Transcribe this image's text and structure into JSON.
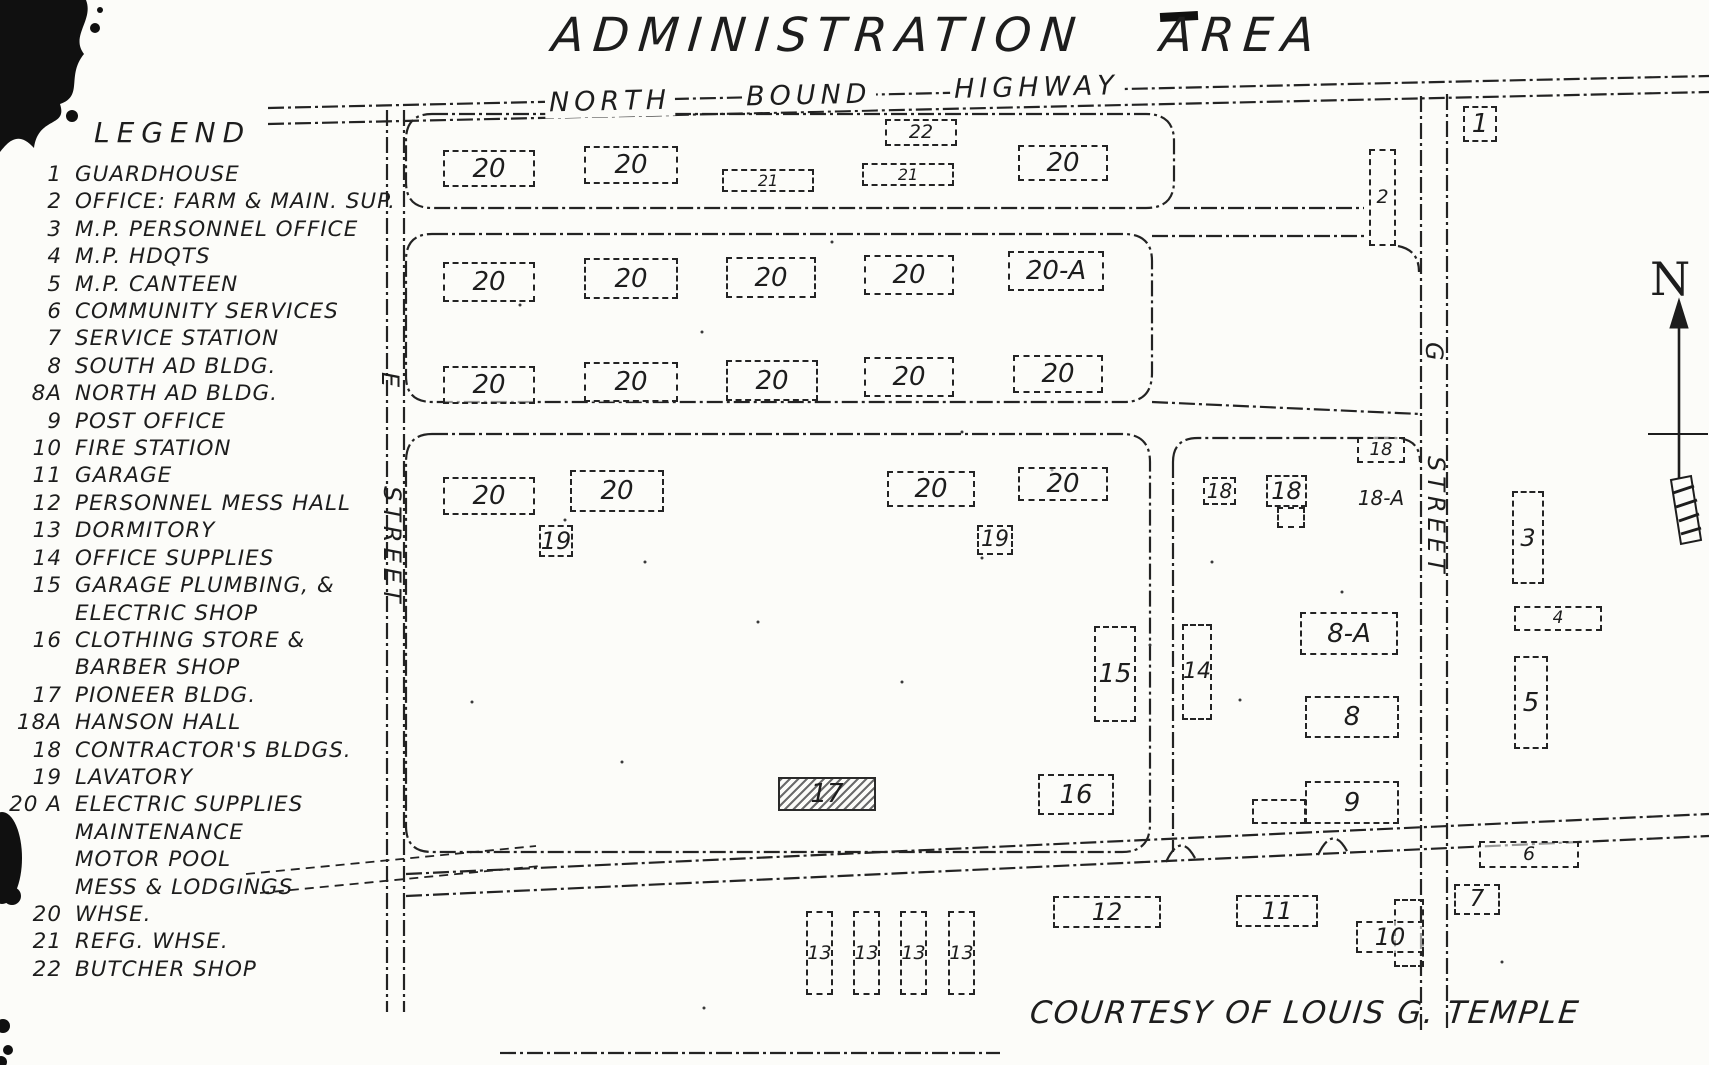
{
  "title": "ADMINISTRATION AREA",
  "credit": "COURTESY OF LOUIS G. TEMPLE",
  "compass": {
    "label": "N"
  },
  "colors": {
    "ink": "#1d1d1d",
    "paper": "#fcfcf9"
  },
  "roads": {
    "highway": {
      "words": [
        "NORTH",
        "BOUND",
        "HIGHWAY"
      ]
    },
    "left_street": {
      "letter": "E",
      "name": "STREET"
    },
    "right_street": {
      "letter": "G",
      "name": "STREET"
    }
  },
  "legend": {
    "heading": "LEGEND",
    "items": [
      {
        "num": "1",
        "lines": [
          "GUARDHOUSE"
        ]
      },
      {
        "num": "2",
        "lines": [
          "OFFICE: FARM & MAIN. SUP."
        ]
      },
      {
        "num": "3",
        "lines": [
          "M.P. PERSONNEL OFFICE"
        ]
      },
      {
        "num": "4",
        "lines": [
          "M.P. HDQTS"
        ]
      },
      {
        "num": "5",
        "lines": [
          "M.P. CANTEEN"
        ]
      },
      {
        "num": "6",
        "lines": [
          "COMMUNITY SERVICES"
        ]
      },
      {
        "num": "7",
        "lines": [
          "SERVICE STATION"
        ]
      },
      {
        "num": "8",
        "lines": [
          "SOUTH AD BLDG."
        ]
      },
      {
        "num": "8A",
        "lines": [
          "NORTH AD BLDG."
        ]
      },
      {
        "num": "9",
        "lines": [
          "POST OFFICE"
        ]
      },
      {
        "num": "10",
        "lines": [
          "FIRE STATION"
        ]
      },
      {
        "num": "11",
        "lines": [
          "GARAGE"
        ]
      },
      {
        "num": "12",
        "lines": [
          "PERSONNEL MESS HALL"
        ]
      },
      {
        "num": "13",
        "lines": [
          "DORMITORY"
        ]
      },
      {
        "num": "14",
        "lines": [
          "OFFICE SUPPLIES"
        ]
      },
      {
        "num": "15",
        "lines": [
          "GARAGE PLUMBING, &",
          "ELECTRIC SHOP"
        ]
      },
      {
        "num": "16",
        "lines": [
          "CLOTHING STORE &",
          "BARBER SHOP"
        ]
      },
      {
        "num": "17",
        "lines": [
          "PIONEER BLDG."
        ]
      },
      {
        "num": "18A",
        "lines": [
          "HANSON HALL"
        ]
      },
      {
        "num": "18",
        "lines": [
          "CONTRACTOR'S BLDGS."
        ]
      },
      {
        "num": "19",
        "lines": [
          "LAVATORY"
        ]
      },
      {
        "num": "20 A",
        "lines": [
          "ELECTRIC SUPPLIES",
          "MAINTENANCE",
          "MOTOR POOL",
          "MESS & LODGINGS"
        ]
      },
      {
        "num": "20",
        "lines": [
          "WHSE."
        ]
      },
      {
        "num": "21",
        "lines": [
          "REFG. WHSE."
        ]
      },
      {
        "num": "22",
        "lines": [
          "BUTCHER SHOP"
        ]
      }
    ]
  },
  "map": {
    "buildings": [
      {
        "label": "20",
        "x": 443,
        "y": 150,
        "w": 92,
        "h": 37
      },
      {
        "label": "20",
        "x": 584,
        "y": 146,
        "w": 94,
        "h": 38
      },
      {
        "label": "21",
        "x": 722,
        "y": 169,
        "w": 92,
        "h": 23
      },
      {
        "label": "21",
        "x": 862,
        "y": 163,
        "w": 92,
        "h": 23
      },
      {
        "label": "22",
        "x": 885,
        "y": 119,
        "w": 72,
        "h": 27
      },
      {
        "label": "20",
        "x": 1018,
        "y": 145,
        "w": 90,
        "h": 36
      },
      {
        "label": "20",
        "x": 443,
        "y": 262,
        "w": 92,
        "h": 40
      },
      {
        "label": "20",
        "x": 584,
        "y": 258,
        "w": 94,
        "h": 41
      },
      {
        "label": "20",
        "x": 726,
        "y": 257,
        "w": 90,
        "h": 41
      },
      {
        "label": "20",
        "x": 864,
        "y": 255,
        "w": 90,
        "h": 40
      },
      {
        "label": "20-A",
        "x": 1008,
        "y": 251,
        "w": 96,
        "h": 40
      },
      {
        "label": "20",
        "x": 443,
        "y": 366,
        "w": 92,
        "h": 38
      },
      {
        "label": "20",
        "x": 584,
        "y": 362,
        "w": 94,
        "h": 40
      },
      {
        "label": "20",
        "x": 726,
        "y": 360,
        "w": 92,
        "h": 41
      },
      {
        "label": "20",
        "x": 864,
        "y": 357,
        "w": 90,
        "h": 40
      },
      {
        "label": "20",
        "x": 1013,
        "y": 355,
        "w": 90,
        "h": 38
      },
      {
        "label": "2",
        "x": 1369,
        "y": 149,
        "w": 27,
        "h": 97
      },
      {
        "label": "1",
        "x": 1463,
        "y": 106,
        "w": 34,
        "h": 36
      },
      {
        "label": "20",
        "x": 443,
        "y": 477,
        "w": 92,
        "h": 38
      },
      {
        "label": "20",
        "x": 570,
        "y": 470,
        "w": 94,
        "h": 42
      },
      {
        "label": "20",
        "x": 887,
        "y": 471,
        "w": 88,
        "h": 36
      },
      {
        "label": "20",
        "x": 1018,
        "y": 467,
        "w": 90,
        "h": 34
      },
      {
        "label": "19",
        "x": 539,
        "y": 525,
        "w": 34,
        "h": 32
      },
      {
        "label": "19",
        "x": 977,
        "y": 525,
        "w": 36,
        "h": 30
      },
      {
        "label": "15",
        "x": 1094,
        "y": 626,
        "w": 42,
        "h": 96
      },
      {
        "label": "17",
        "x": 778,
        "y": 777,
        "w": 98,
        "h": 34,
        "variant": "hatched"
      },
      {
        "label": "16",
        "x": 1038,
        "y": 774,
        "w": 76,
        "h": 41
      },
      {
        "label": "18",
        "x": 1357,
        "y": 437,
        "w": 48,
        "h": 26
      },
      {
        "label": "18",
        "x": 1203,
        "y": 477,
        "w": 33,
        "h": 28
      },
      {
        "label": "18",
        "x": 1266,
        "y": 475,
        "w": 41,
        "h": 32
      },
      {
        "label": "",
        "x": 1277,
        "y": 507,
        "w": 28,
        "h": 21,
        "variant": "annex"
      },
      {
        "label": "18-A",
        "x": 1350,
        "y": 484,
        "w": 62,
        "h": 28,
        "variant": "text"
      },
      {
        "label": "14",
        "x": 1182,
        "y": 624,
        "w": 30,
        "h": 96
      },
      {
        "label": "8-A",
        "x": 1300,
        "y": 612,
        "w": 98,
        "h": 43
      },
      {
        "label": "8",
        "x": 1305,
        "y": 696,
        "w": 94,
        "h": 42
      },
      {
        "label": "9",
        "x": 1305,
        "y": 781,
        "w": 94,
        "h": 43
      },
      {
        "label": "",
        "x": 1252,
        "y": 799,
        "w": 54,
        "h": 25,
        "variant": "annex"
      },
      {
        "label": "3",
        "x": 1512,
        "y": 491,
        "w": 32,
        "h": 93
      },
      {
        "label": "4",
        "x": 1514,
        "y": 606,
        "w": 88,
        "h": 25
      },
      {
        "label": "5",
        "x": 1514,
        "y": 656,
        "w": 34,
        "h": 93
      },
      {
        "label": "6",
        "x": 1479,
        "y": 841,
        "w": 100,
        "h": 27
      },
      {
        "label": "7",
        "x": 1454,
        "y": 884,
        "w": 46,
        "h": 31
      },
      {
        "label": "13",
        "x": 806,
        "y": 911,
        "w": 27,
        "h": 84
      },
      {
        "label": "13",
        "x": 853,
        "y": 911,
        "w": 27,
        "h": 84
      },
      {
        "label": "13",
        "x": 900,
        "y": 911,
        "w": 27,
        "h": 84
      },
      {
        "label": "13",
        "x": 948,
        "y": 911,
        "w": 27,
        "h": 84
      },
      {
        "label": "12",
        "x": 1053,
        "y": 896,
        "w": 108,
        "h": 32
      },
      {
        "label": "11",
        "x": 1236,
        "y": 895,
        "w": 82,
        "h": 32
      },
      {
        "label": "",
        "x": 1394,
        "y": 899,
        "w": 30,
        "h": 68,
        "variant": "annex"
      },
      {
        "label": "10",
        "x": 1356,
        "y": 921,
        "w": 68,
        "h": 32
      }
    ]
  }
}
